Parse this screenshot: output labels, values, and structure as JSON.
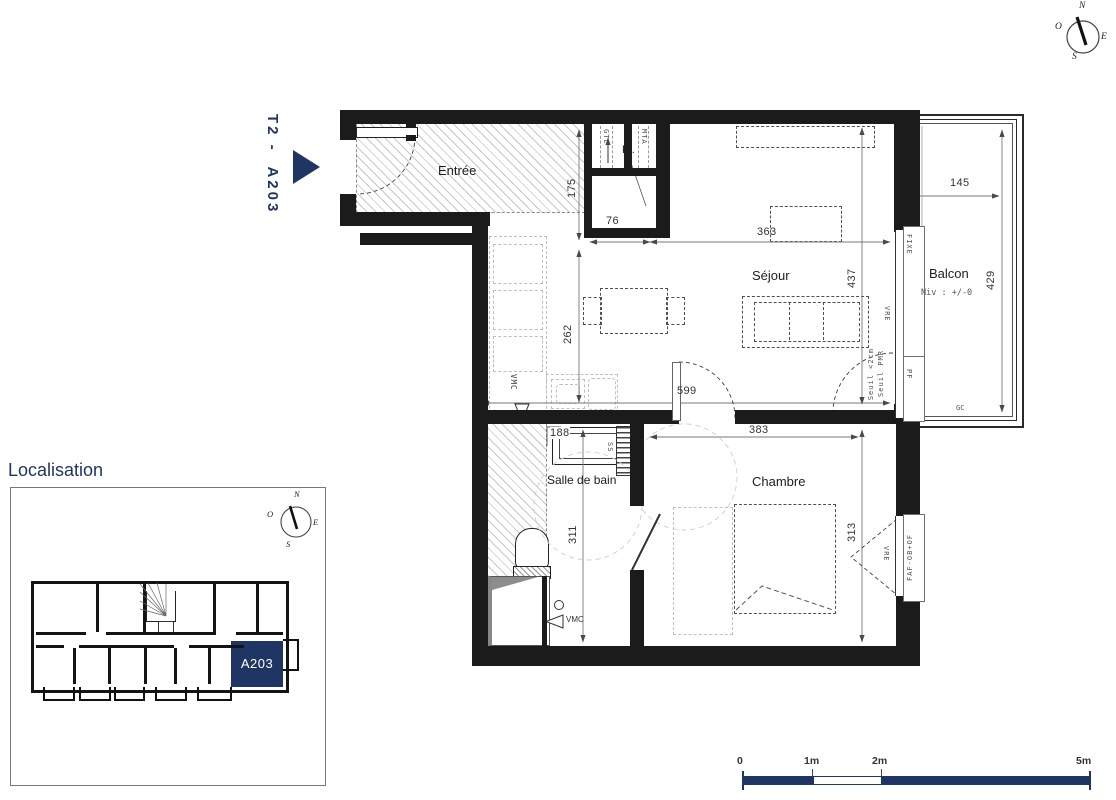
{
  "plan": {
    "unit_ref": "T2 -  A203",
    "rooms": {
      "entree": "Entrée",
      "sejour": "Séjour",
      "balcon": "Balcon",
      "balcon_level": "Niv : +/-0",
      "salle_de_bain": "Salle de bain",
      "chambre": "Chambre",
      "placard": "Pl."
    },
    "dimensions_cm": {
      "entree_depth": "175",
      "placard_width": "76",
      "sejour_width": "363",
      "sejour_depth": "437",
      "kitchen_depth": "262",
      "sejour_total_width": "599",
      "sdb_width": "188",
      "sdb_depth": "311",
      "chambre_width": "383",
      "chambre_depth": "313",
      "balcon_width": "145",
      "balcon_depth": "429"
    },
    "annotations": {
      "gtl": "GTL",
      "mta": "MTA",
      "vmc": "VMC",
      "fixe": "FIXE",
      "vre": "VRE",
      "pf": "PF",
      "seuil_1": "Seuil <2cm",
      "seuil_2": "Seuil PMR",
      "ss": "SS",
      "gc": "GC",
      "faf": "FAF-OB+OF"
    }
  },
  "compass": {
    "n": "N",
    "o": "O",
    "e": "E",
    "s": "S"
  },
  "localisation": {
    "title": "Localisation",
    "highlight_unit": "A203"
  },
  "scale_bar": {
    "zero": "0",
    "one": "1m",
    "two": "2m",
    "five": "5m"
  },
  "colors": {
    "navy": "#1f3563",
    "wall": "#1b1b1b"
  }
}
